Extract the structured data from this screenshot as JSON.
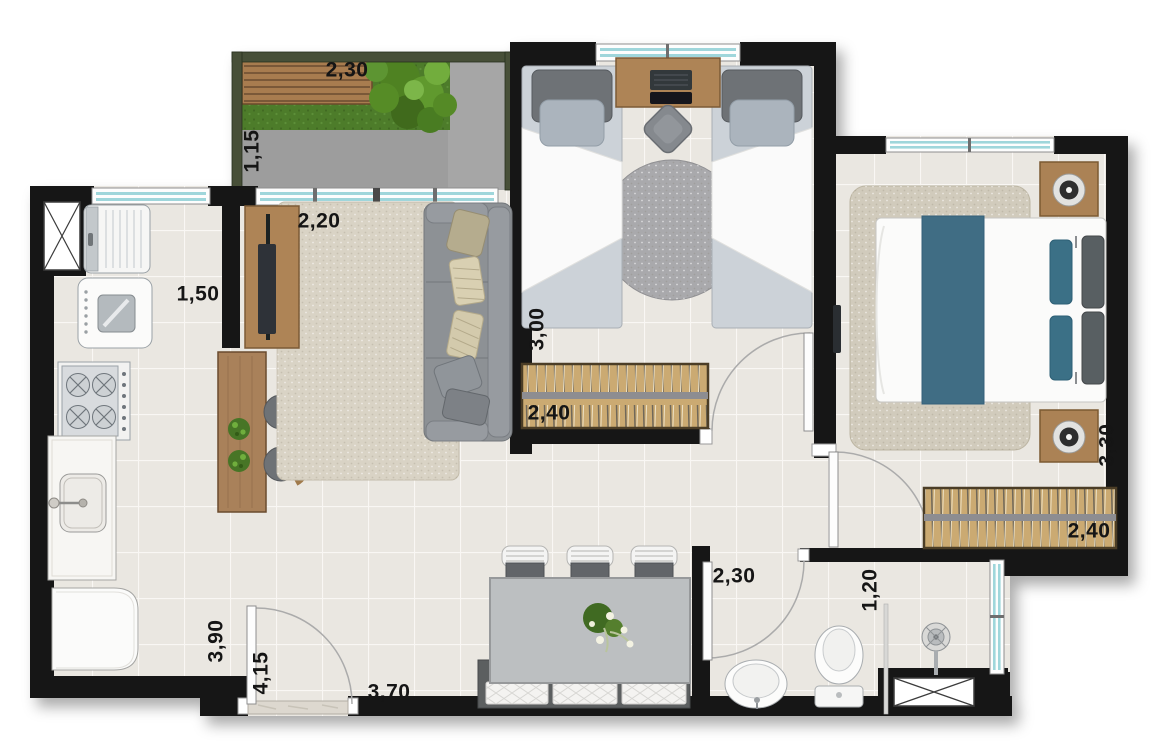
{
  "plan": {
    "kind": "apartment-floor-plan-top-view",
    "dims": {
      "balcony_length": "2,30",
      "balcony_depth": "1,15",
      "kitchen_width": "1,50",
      "living_width": "2,20",
      "bedroom2_depth": "3,00",
      "bedroom2_wardrobe_width": "2,40",
      "master_depth": "3,30",
      "master_wardrobe_width": "2,40",
      "kitchen_depth": "3,90",
      "entry_hall_depth": "4,15",
      "dining_width": "3,70",
      "bathroom_length": "2,30",
      "bathroom_width": "1,20"
    },
    "colors": {
      "wall": "#181818",
      "floor_tile": "#eae7e1",
      "grout": "#f9f7f4",
      "balcony_concrete": "#9d9d9d",
      "grass": "#4e7c2c",
      "wood": "#ae8457",
      "wardrobe_wood": "#cbaa72",
      "window_glass": "#9fd6db",
      "sofa_gray": "#8d9195",
      "bed_runner_teal": "#3f6d84",
      "rug_beige": "#d9d3c5"
    },
    "rooms": [
      {
        "name": "balcony",
        "furniture": [
          "wooden-deck-bench",
          "garden-grass",
          "bush"
        ]
      },
      {
        "name": "kitchen",
        "furniture": [
          "service-shaft",
          "fridge",
          "washing-machine",
          "stove",
          "sink-counter",
          "laundry-appliance",
          "bar-counter",
          "bar-stools",
          "plants"
        ]
      },
      {
        "name": "living-room",
        "furniture": [
          "tv-rack",
          "tv",
          "rug",
          "sofa"
        ]
      },
      {
        "name": "bedroom-2",
        "furniture": [
          "single-bed",
          "single-bed",
          "desk",
          "laptop",
          "desk-chair",
          "round-rug",
          "wardrobe"
        ]
      },
      {
        "name": "master-bedroom",
        "furniture": [
          "double-bed",
          "nightstand",
          "lamp",
          "nightstand",
          "lamp",
          "rug",
          "wardrobe",
          "wall-tv"
        ]
      },
      {
        "name": "dining-area",
        "furniture": [
          "dining-table",
          "dining-chairs",
          "bench",
          "flower-centerpiece"
        ]
      },
      {
        "name": "bathroom",
        "furniture": [
          "washbasin",
          "toilet",
          "shower-head",
          "shower-divider",
          "service-shaft"
        ]
      }
    ]
  }
}
